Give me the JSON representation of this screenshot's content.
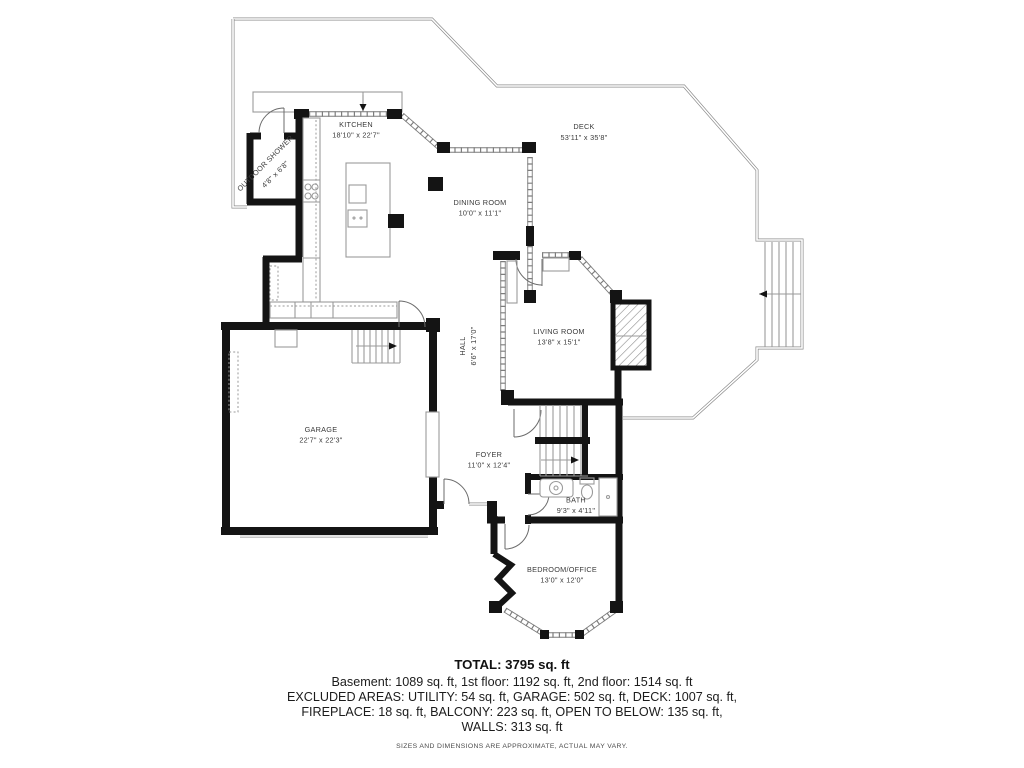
{
  "rooms": [
    {
      "name": "KITCHEN",
      "dims": "18'10\" x 22'7\""
    },
    {
      "name": "DECK",
      "dims": "53'11\" x 35'8\""
    },
    {
      "name": "DINING ROOM",
      "dims": "10'0\" x 11'1\""
    },
    {
      "name": "OUTDOOR SHOWER",
      "dims": "4'8\" x 6'8\""
    },
    {
      "name": "LIVING ROOM",
      "dims": "13'8\" x 15'1\""
    },
    {
      "name": "HALL",
      "dims": "6'6\" x 17'0\""
    },
    {
      "name": "GARAGE",
      "dims": "22'7\" x 22'3\""
    },
    {
      "name": "FOYER",
      "dims": "11'0\" x 12'4\""
    },
    {
      "name": "BATH",
      "dims": "9'3\" x 4'11\""
    },
    {
      "name": "BEDROOM/OFFICE",
      "dims": "13'0\" x 12'0\""
    }
  ],
  "summary": {
    "total": "TOTAL: 3795 sq. ft",
    "line1": "Basement: 1089 sq. ft, 1st floor: 1192 sq. ft, 2nd floor: 1514 sq. ft",
    "line2": "EXCLUDED AREAS: UTILITY: 54 sq. ft, GARAGE: 502 sq. ft, DECK: 1007 sq. ft,",
    "line3": "FIREPLACE: 18 sq. ft, BALCONY: 223 sq. ft, OPEN TO BELOW: 135 sq. ft,",
    "line4": "WALLS: 313 sq. ft",
    "disclaimer": "SIZES AND DIMENSIONS ARE APPROXIMATE, ACTUAL MAY VARY."
  },
  "colors": {
    "wall": "#141414",
    "thin_line": "#8c8c8c",
    "label": "#3a3a3a",
    "background": "#ffffff"
  }
}
